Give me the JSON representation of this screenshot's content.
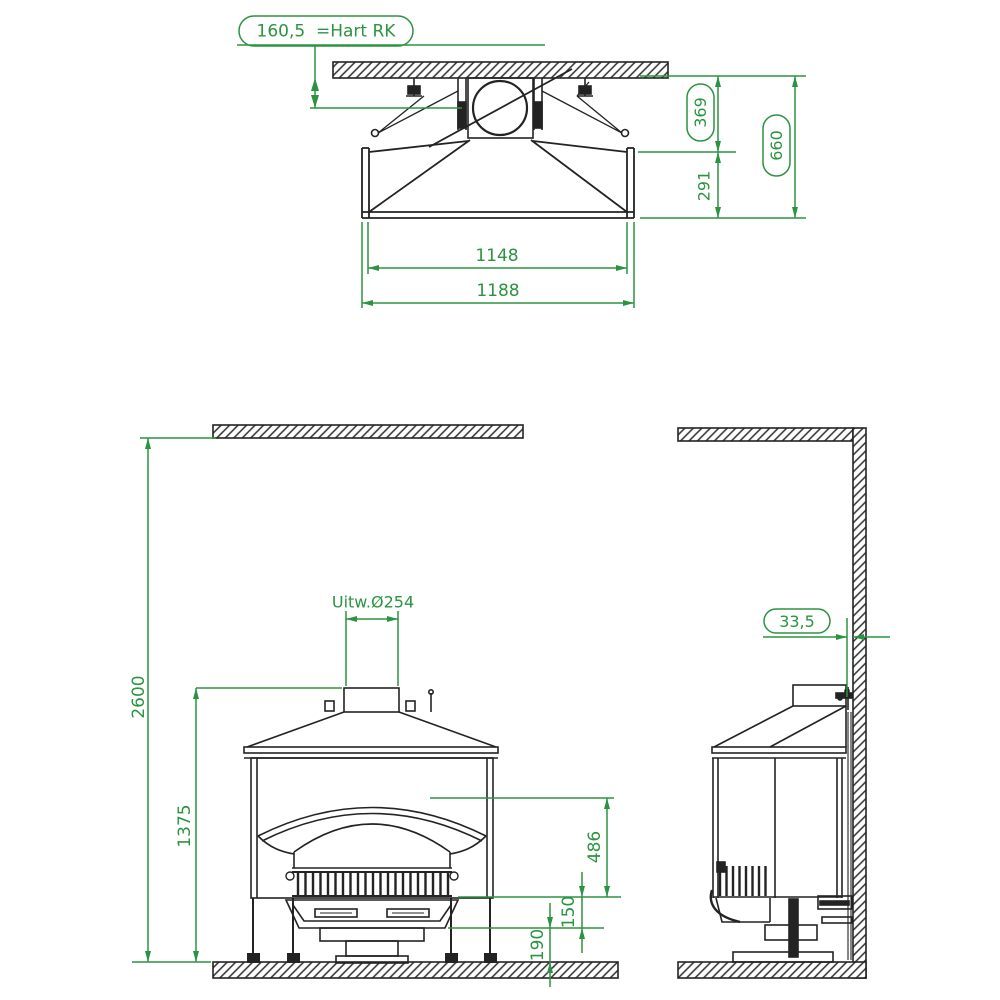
{
  "colors": {
    "line": "#232323",
    "dimension": "#2b9440",
    "background": "#ffffff"
  },
  "top_view": {
    "label_hart": "160,5  =Hart RK",
    "dim_369": "369",
    "dim_291": "291",
    "dim_660": "660",
    "dim_1148": "1148",
    "dim_1188": "1188"
  },
  "front_view": {
    "dim_2600": "2600",
    "dim_1375": "1375",
    "label_flue": "Uitw.Ø254",
    "dim_486": "486",
    "dim_150": "150",
    "dim_190": "190"
  },
  "side_view": {
    "dim_33_5": "33,5"
  }
}
